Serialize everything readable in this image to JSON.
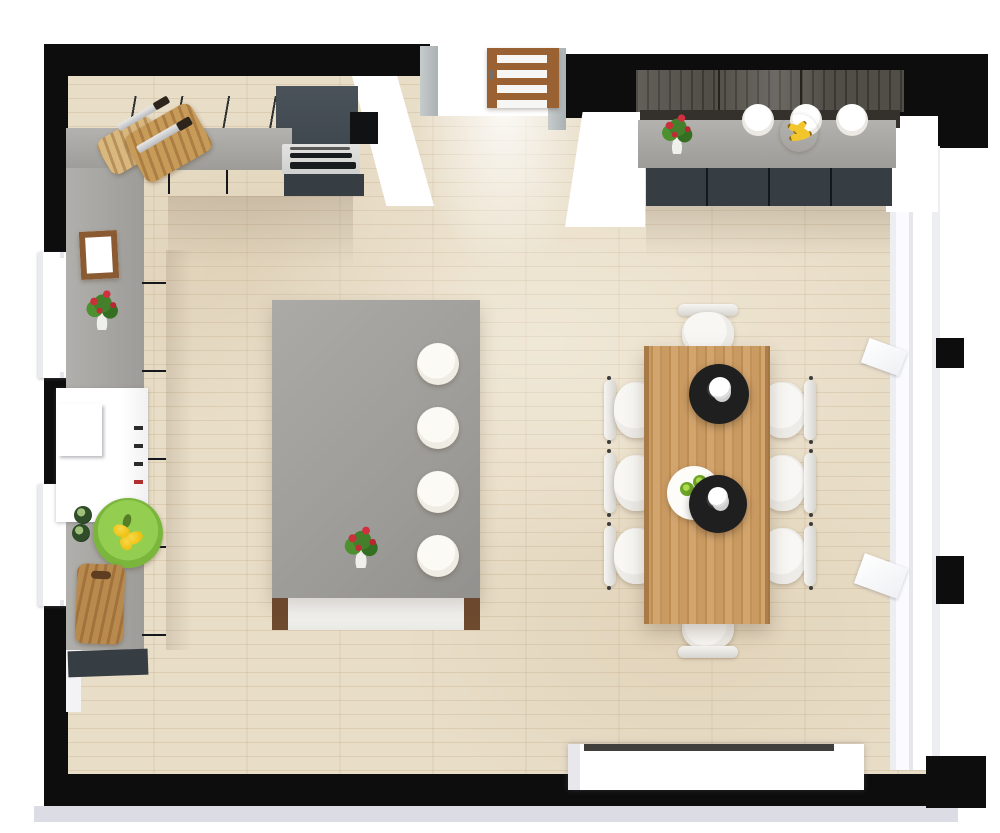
{
  "palette": {
    "wall": "#0d0d0d",
    "exterior_trim": "#dcdde4",
    "floor": "#e8ddc7",
    "counter_gray": "#9d9c98",
    "cabinet_dark": "#363d43",
    "wall_cabinet": "#4d565d",
    "backsplash_wood": "#514d47",
    "shelf_dark": "#34302b",
    "island_top": "#9c9b97",
    "island_front": "#e9e9e5",
    "wood_post": "#6e4a2f",
    "table_wood": "#c99a62",
    "chair_white": "#eeece8",
    "stool_white": "#efece4",
    "pendant_black": "#1f1f1f",
    "door_wood": "#9a6233",
    "jamb_gray": "#aab1b2",
    "window_white": "#ffffff",
    "steel": "#cfcfcd",
    "plate_green": "#7ab53c",
    "lemon_yellow": "#eec011",
    "flower_red": "#c8303a",
    "leaf_green": "#44802b",
    "banana_yellow": "#f3c52c",
    "lime_green": "#6ea526"
  },
  "inventory": {
    "dining_chairs": 8,
    "island_stools": 4,
    "pendant_lamps": 2,
    "shelf_plates": 3,
    "flower_pots": 3,
    "cutting_boards": 3,
    "left_windows": 2,
    "right_window_sections": 3,
    "doors": 1,
    "kitchen_counters": 2,
    "kitchen_island": 1,
    "white_appliances": 1,
    "console_sideboards": 1
  }
}
